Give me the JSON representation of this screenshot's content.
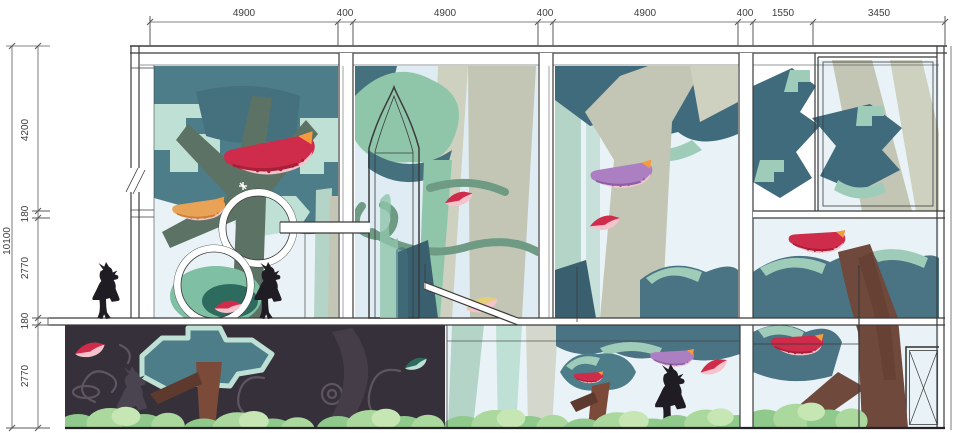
{
  "drawing": {
    "kind": "architectural interior elevation with forest mural",
    "dims": {
      "top": [
        "4900",
        "400",
        "4900",
        "400",
        "4900",
        "400",
        "1550",
        "3450"
      ],
      "left_total": "10100",
      "left": [
        "4200",
        "180",
        "2770",
        "180",
        "2770"
      ]
    }
  },
  "palette": {
    "paper": "#ffffff",
    "line": "#3b3b3b",
    "dim_line": "#5a5a5a",
    "text": "#3d3d3d",
    "sky": "#dfecf3",
    "sky_light": "#e9f3f7",
    "glass": "#eef4f6",
    "teal_bg": "#4e7d8a",
    "teal_dark": "#3f6b7c",
    "teal_mid": "#4a7383",
    "slate": "#45707e",
    "slate_dark": "#3a5f6e",
    "teal_deep": "#2e6b5f",
    "mint": "#9fccb9",
    "mint_light": "#bfe0d4",
    "mint_trunk": "#b3d4c6",
    "mint_canopy": "#8fc6aa",
    "mint_blob": "#7fbfa3",
    "sage": "#5c7264",
    "beige": "#c3c6b4",
    "beige_light": "#ced1c0",
    "brown": "#6f4a3c",
    "brown_dark": "#5e3a2e",
    "brown_red": "#7b4a39",
    "cup_red": "#cf2b4a",
    "cup_red_dark": "#a81f38",
    "cup_orange": "#e8a356",
    "cup_orange_dark": "#c97f35",
    "cup_purple": "#ab7fc2",
    "cup_purple_dark": "#8c5fa6",
    "pink_band": "#f4c3cb",
    "tab_orange": "#f59b3d",
    "yellow_leaf": "#e5cf7d",
    "vine": "#6f9b85",
    "dark_bg": "#35303a",
    "swirl": "#5d5560",
    "shadow_plant": "#453e49",
    "bush": "#abd89d",
    "bush_dark": "#8fc98c",
    "bush_light": "#c6e6b4",
    "silhouette": "#201c23",
    "silhouette_soft": "#4a4350"
  }
}
